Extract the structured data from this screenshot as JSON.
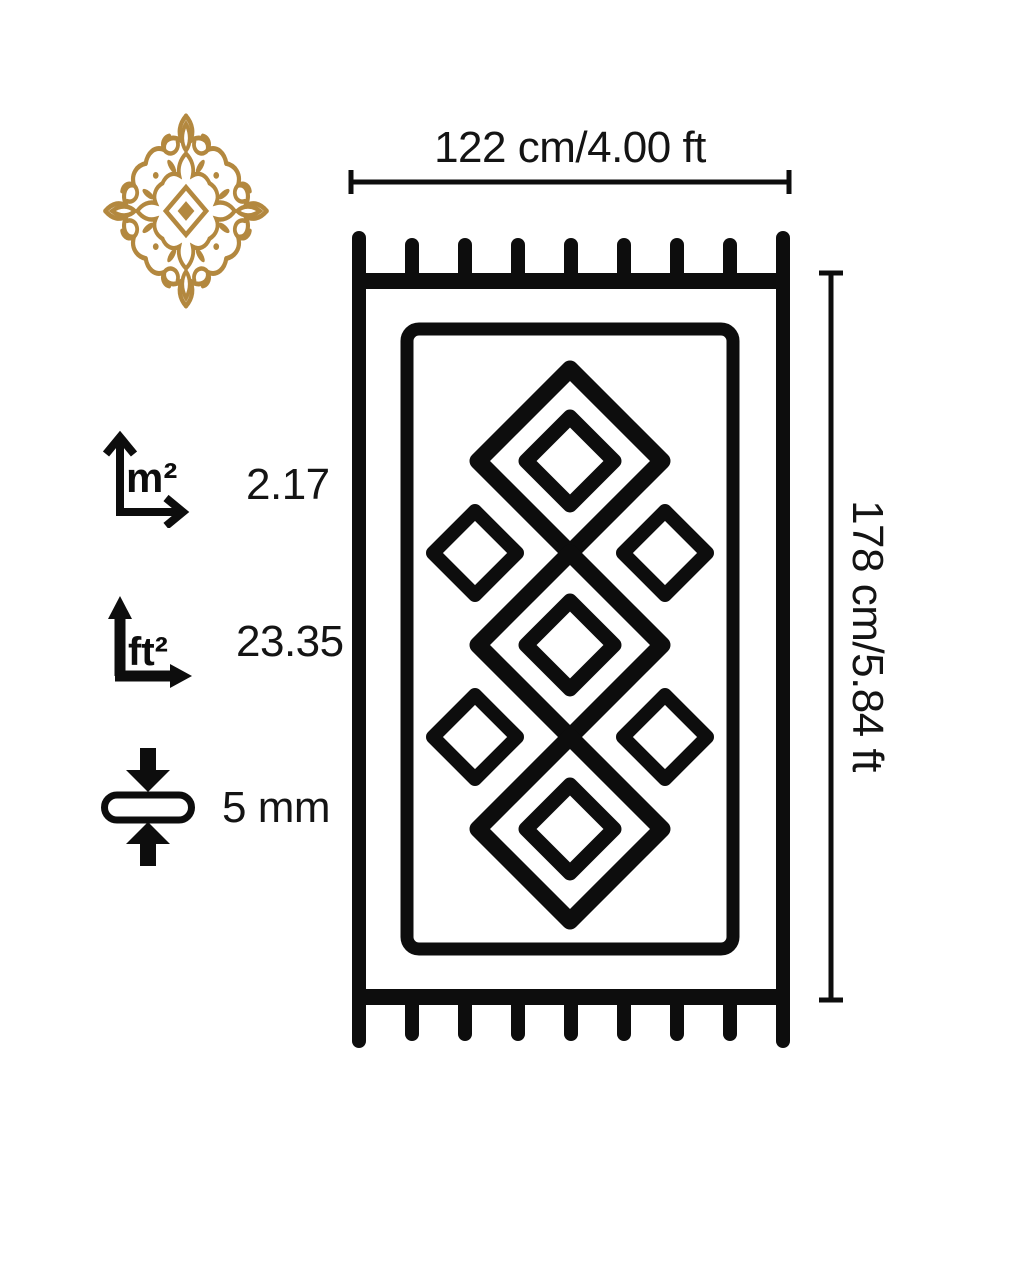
{
  "colors": {
    "ink": "#0d0d0d",
    "gold": "#b3883f",
    "background": "#ffffff"
  },
  "brand": {
    "ornament_icon": "arabesque-medallion-icon"
  },
  "dimensions": {
    "width_label": "122 cm/4.00 ft",
    "height_label": "178 cm/5.84 ft"
  },
  "specs": {
    "area_m2": {
      "icon": "area-m2-icon",
      "unit": "m²",
      "value": "2.17"
    },
    "area_ft2": {
      "icon": "area-ft2-icon",
      "unit": "ft²",
      "value": "23.35"
    },
    "thickness": {
      "icon": "thickness-icon",
      "value": "5 mm"
    }
  },
  "illustration": {
    "name": "rug-top-view-diagram"
  }
}
